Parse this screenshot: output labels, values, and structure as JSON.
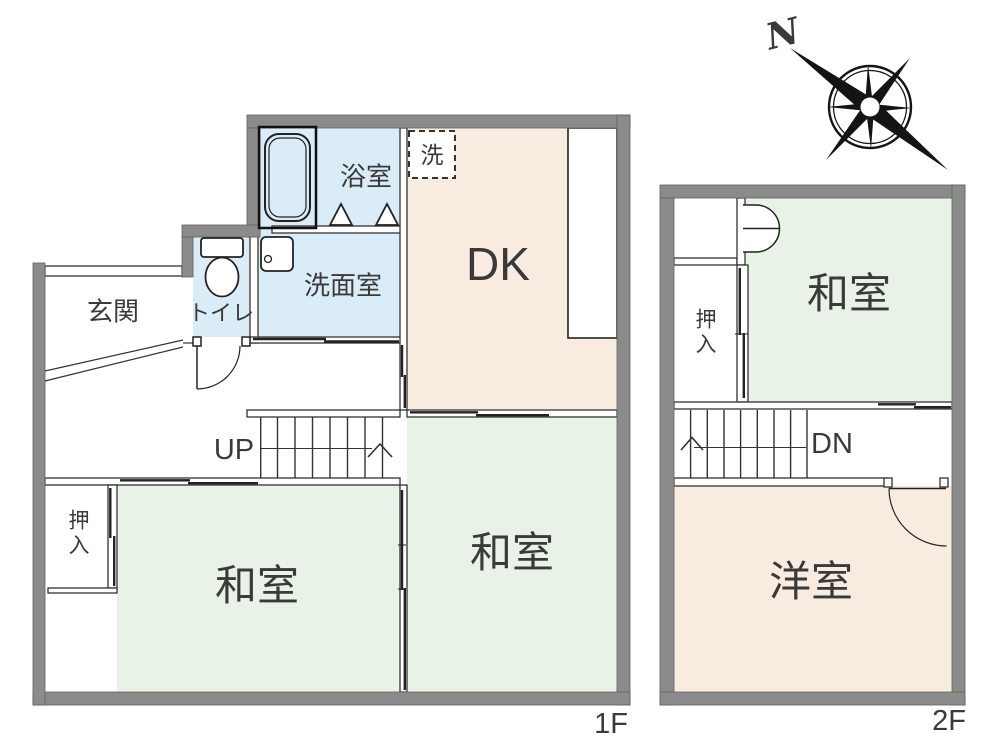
{
  "colors": {
    "wall": "#8b8b8b",
    "wall_edge": "#5f5f5f",
    "water_room": "#daecf7",
    "warm_room": "#f8ece1",
    "tatami_room": "#e9f2e7",
    "line": "#2f2f2f",
    "text": "#3a3a3a"
  },
  "floor1": {
    "floor_label": "1F",
    "rooms": {
      "genkan": "玄関",
      "toilet": "トイレ",
      "bath": "浴室",
      "washroom": "洗面室",
      "washer": "洗",
      "dining_kitchen": "DK",
      "tatami_right": "和室",
      "tatami_left": "和室",
      "closet": "押入",
      "stairs": "UP"
    }
  },
  "floor2": {
    "floor_label": "2F",
    "rooms": {
      "tatami": "和室",
      "closet": "押入",
      "stairs": "DN",
      "western": "洋室"
    }
  },
  "compass": {
    "north_label": "N"
  }
}
